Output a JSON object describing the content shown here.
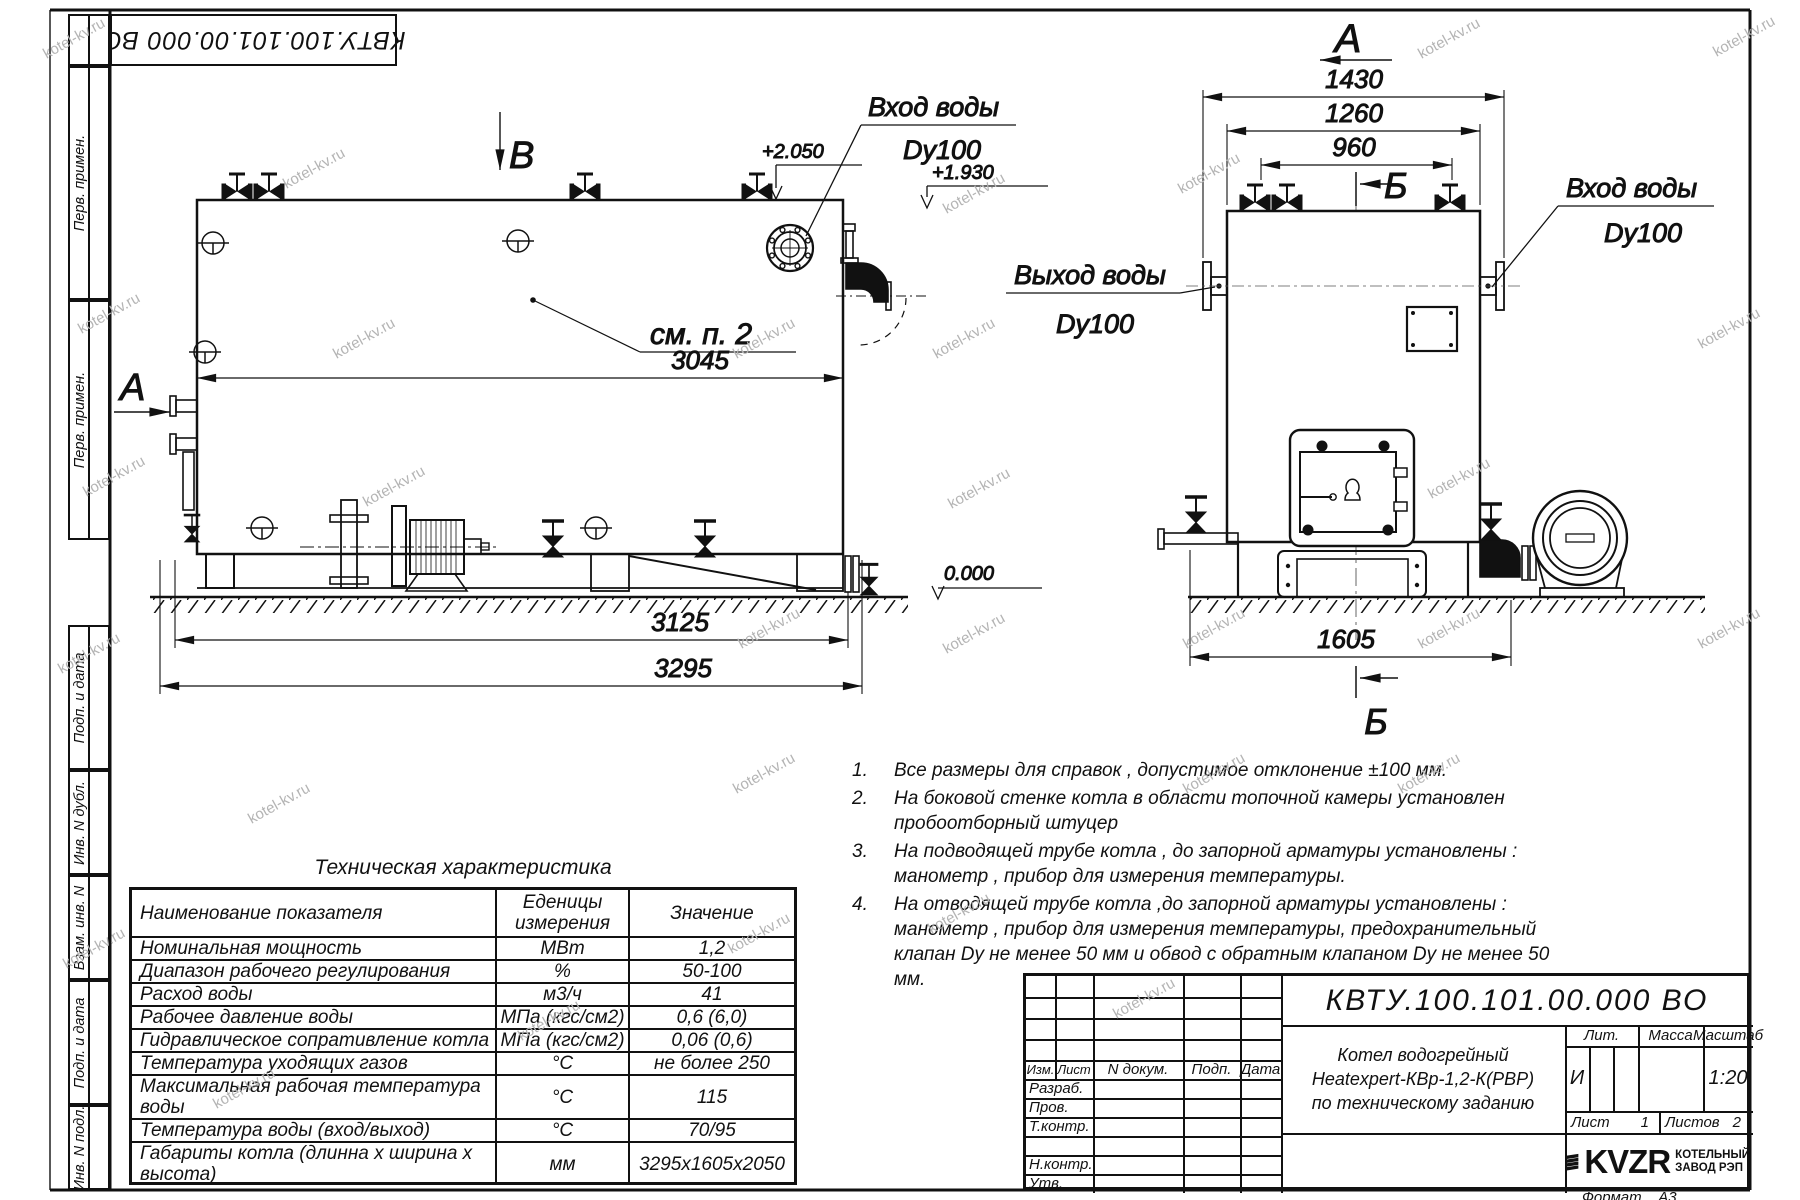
{
  "watermark": "kotel-kv.ru",
  "top_stamp": "КВТУ.100.101.00.000  ВО",
  "margin": {
    "upper": [
      "Перв. примен.",
      "Перв. примен."
    ],
    "lower": [
      "Подп. и дата",
      "Инв. N дубл.",
      "Взам. инв. N",
      "Подп. и дата",
      "Инв. N подл."
    ]
  },
  "side_view": {
    "view_b": "В",
    "view_a": "А",
    "dim_width": "3045",
    "dim_base": "3125",
    "dim_total": "3295",
    "level_top": "+2.050",
    "level_pipe": "+1.930",
    "level_zero": "0.000",
    "note_ref": "см. п. 2",
    "inlet_title": "Вход воды",
    "inlet_dn": "Dy100"
  },
  "front_view": {
    "view_a": "А",
    "section_b": "Б",
    "dim_1430": "1430",
    "dim_1260": "1260",
    "dim_960": "960",
    "dim_1605": "1605",
    "inlet_title": "Вход воды",
    "inlet_dn": "Dy100",
    "outlet_title": "Выход воды",
    "outlet_dn": "Dy100"
  },
  "tech_table": {
    "title": "Техническая характеристика",
    "headers": [
      "Наименование показателя",
      "Еденицы измерения",
      "Значение"
    ],
    "rows": [
      {
        "name": "Номинальная мощность",
        "unit": "МВт",
        "value": "1,2"
      },
      {
        "name": "Диапазон рабочего регулирования",
        "unit": "%",
        "value": "50-100"
      },
      {
        "name": "Расход воды",
        "unit": "м3/ч",
        "value": "41"
      },
      {
        "name": "Рабочее давление воды",
        "unit": "МПа (кгс/см2)",
        "value": "0,6 (6,0)"
      },
      {
        "name": "Гидравлическое сопративление котла",
        "unit": "МПа (кгс/см2)",
        "value": "0,06 (0,6)"
      },
      {
        "name": "Температура уходящих газов",
        "unit": "°С",
        "value": "не более 250"
      },
      {
        "name": "Максимальная рабочая температура воды",
        "unit": "°С",
        "value": "115"
      },
      {
        "name": "Температура воды (вход/выход)",
        "unit": "°С",
        "value": "70/95"
      },
      {
        "name": "Габариты котла (длинна х ширина х высота)",
        "unit": "мм",
        "value": "3295х1605х2050"
      }
    ]
  },
  "notes": [
    {
      "num": "1.",
      "text": "Все размеры для справок , допустимое отклонение  ±100 мм."
    },
    {
      "num": "2.",
      "text": "На боковой стенке котла в области топочной камеры установлен пробоотборный штуцер"
    },
    {
      "num": "3.",
      "text": "На   подводящей трубе котла , до запорной арматуры установлены : манометр , прибор для измерения температуры."
    },
    {
      "num": "4.",
      "text": "На отводящей трубе котла ,до запорной арматуры установлены : манометр , прибор для измерения температуры, предохранительный клапан  Dу не менее  50 мм и обвод с обратным клапаном  Dу не менее  50 мм."
    }
  ],
  "title_block": {
    "doc_number": "КВТУ.100.101.00.000  ВО",
    "header_cols": [
      "Изм.",
      "Лист",
      "N докум.",
      "Подп.",
      "Дата"
    ],
    "rows": [
      "Разраб.",
      "Пров.",
      "Т.контр.",
      "",
      "Н.контр.",
      "Утв."
    ],
    "product_line1": "Котел водогрейный",
    "product_line2": "Heatexpert-КВр-1,2-К(РВР)",
    "product_line3": "по техническому заданию",
    "lit_label": "Лит.",
    "lit_value": "И",
    "mass_label": "Масса",
    "scale_label": "Масштаб",
    "scale_value": "1:20",
    "sheet_label": "Лист",
    "sheet_value": "1",
    "sheets_label": "Листов",
    "sheets_value": "2",
    "logo_text": "KVZR",
    "company_line1": "КОТЕЛЬНЫЙ",
    "company_line2": "ЗАВОД РЭП",
    "format_label": "Формат",
    "format_value": "А3"
  }
}
